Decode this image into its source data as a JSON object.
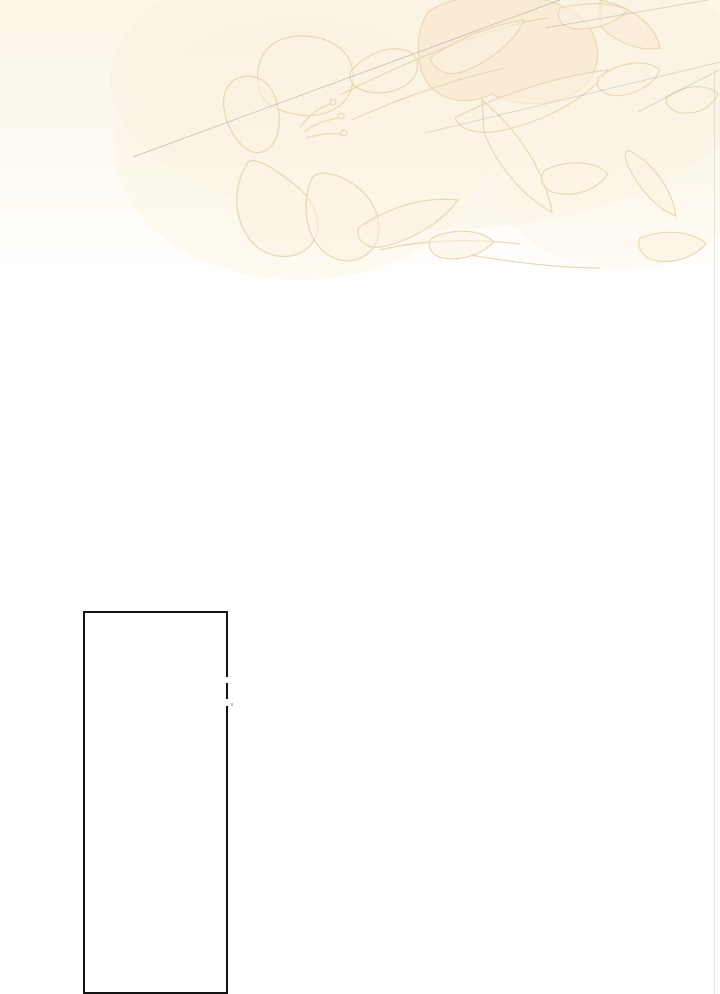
{
  "page": {
    "background_color": "#ffffff",
    "top_tint_color": "#fdf7e9"
  },
  "header_artwork": {
    "kind": "faint-floral-line-sketch",
    "outline_color": "#e9d8b5",
    "cream_fill_color": "#fbf3e1",
    "peach_fill_color": "#f8e7cd",
    "sketch_line_color": "#8d97a1"
  },
  "right_seam": {
    "color": "#cac7c1"
  },
  "panel_frame": {
    "border_color": "#141414",
    "fill_color": "#ffffff"
  }
}
